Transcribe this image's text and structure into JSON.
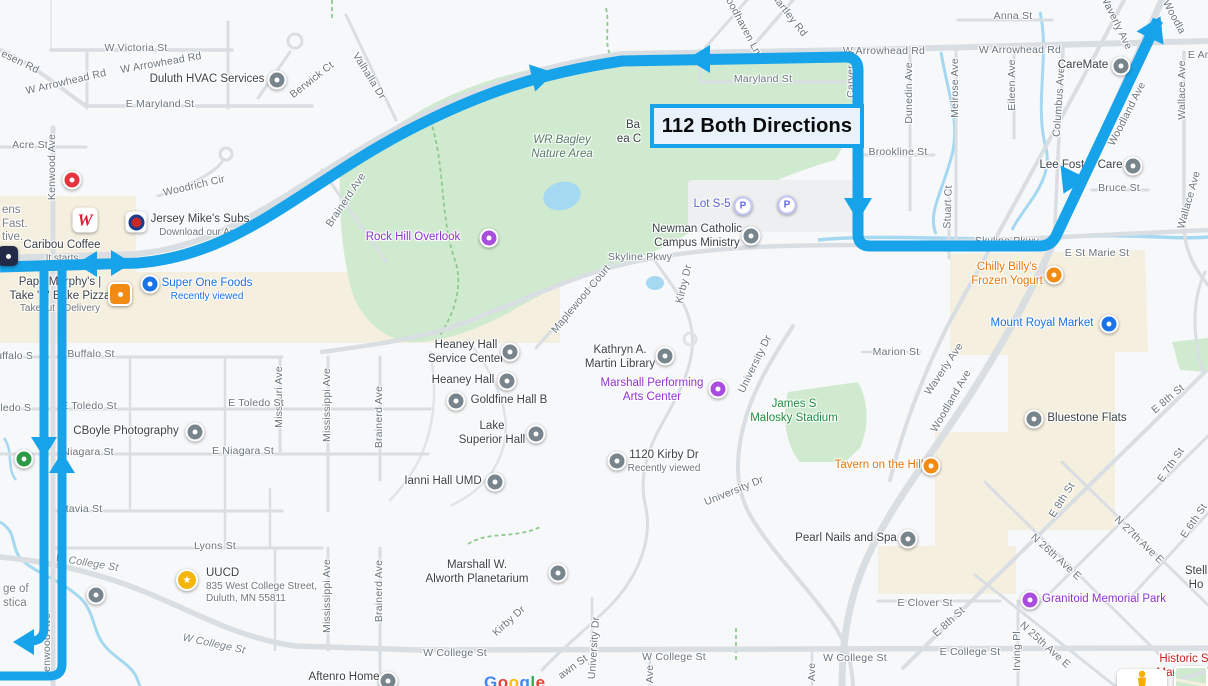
{
  "route": {
    "label": "112 Both Directions",
    "color": "#17a3e9"
  },
  "watermark": {
    "text": "Google",
    "letter_colors": [
      "#4285F4",
      "#EA4335",
      "#FBBC05",
      "#4285F4",
      "#34A853",
      "#EA4335"
    ]
  },
  "map": {
    "streets": [
      {
        "t": "W Victoria St",
        "x": 136,
        "y": 48,
        "r": 0
      },
      {
        "t": "esen Rd",
        "x": 20,
        "y": 62,
        "r": 26
      },
      {
        "t": "E Maryland St",
        "x": 160,
        "y": 104,
        "r": 0
      },
      {
        "t": "Acre St",
        "x": 30,
        "y": 145,
        "r": 0
      },
      {
        "t": "Kenwood Ave",
        "x": 52,
        "y": 167,
        "r": -90
      },
      {
        "t": "Berwick Ct",
        "x": 312,
        "y": 80,
        "r": -38
      },
      {
        "t": "Valhalla Dr",
        "x": 369,
        "y": 76,
        "r": 58
      },
      {
        "t": "W Arrowhead Rd",
        "x": 66,
        "y": 82,
        "r": -13
      },
      {
        "t": "W Arrowhead Rd",
        "x": 161,
        "y": 63,
        "r": -10
      },
      {
        "t": "Woodhaven Ln",
        "x": 741,
        "y": 22,
        "r": 62
      },
      {
        "t": "Hartley Rd",
        "x": 789,
        "y": 15,
        "r": 52
      },
      {
        "t": "Maryland St",
        "x": 763,
        "y": 79,
        "r": 0
      },
      {
        "t": "W Arrowhead Rd",
        "x": 884,
        "y": 51,
        "r": 0
      },
      {
        "t": "W Arrowhead Rd",
        "x": 1020,
        "y": 50,
        "r": 0
      },
      {
        "t": "Anna St",
        "x": 1013,
        "y": 16,
        "r": 0
      },
      {
        "t": "Carver Av",
        "x": 851,
        "y": 74,
        "r": -90
      },
      {
        "t": "Dunedin Ave",
        "x": 909,
        "y": 93,
        "r": -90
      },
      {
        "t": "Melrose Ave",
        "x": 955,
        "y": 88,
        "r": -90
      },
      {
        "t": "Eileen Ave",
        "x": 1012,
        "y": 85,
        "r": -90
      },
      {
        "t": "Columbus Ave",
        "x": 1059,
        "y": 102,
        "r": -86
      },
      {
        "t": "Waverly Ave",
        "x": 1116,
        "y": 22,
        "r": 64
      },
      {
        "t": "Woodla",
        "x": 1174,
        "y": 17,
        "r": 62
      },
      {
        "t": "E Arr",
        "x": 1200,
        "y": 55,
        "r": 0
      },
      {
        "t": "Wallace Ave",
        "x": 1182,
        "y": 90,
        "r": -90
      },
      {
        "t": "Wallace Ave",
        "x": 1189,
        "y": 200,
        "r": -74
      },
      {
        "t": "Brookline St",
        "x": 898,
        "y": 152,
        "r": 0
      },
      {
        "t": "Stuart Ct",
        "x": 948,
        "y": 207,
        "r": -88
      },
      {
        "t": "Bruce St",
        "x": 1119,
        "y": 188,
        "r": 0
      },
      {
        "t": "Skyline Pkwy",
        "x": 640,
        "y": 257,
        "r": 0
      },
      {
        "t": "Skyline Pkwy",
        "x": 1007,
        "y": 241,
        "r": 0
      },
      {
        "t": "E St Marie St",
        "x": 1097,
        "y": 253,
        "r": 0
      },
      {
        "t": "Marion St",
        "x": 896,
        "y": 352,
        "r": 0
      },
      {
        "t": "Waverly Ave",
        "x": 944,
        "y": 369,
        "r": -56
      },
      {
        "t": "Woodland Ave",
        "x": 1127,
        "y": 114,
        "r": -63
      },
      {
        "t": "Woodland Ave",
        "x": 951,
        "y": 401,
        "r": -60
      },
      {
        "t": "Maplewood Court",
        "x": 581,
        "y": 299,
        "r": -50
      },
      {
        "t": "Kirby Dr",
        "x": 684,
        "y": 284,
        "r": -76
      },
      {
        "t": "Kirby Dr",
        "x": 509,
        "y": 621,
        "r": -42
      },
      {
        "t": "University Dr",
        "x": 755,
        "y": 364,
        "r": -64
      },
      {
        "t": "University Dr",
        "x": 734,
        "y": 491,
        "r": -22
      },
      {
        "t": "University Dr",
        "x": 594,
        "y": 648,
        "r": -86
      },
      {
        "t": "Missouri Ave",
        "x": 279,
        "y": 397,
        "r": -90
      },
      {
        "t": "Mississippi Ave",
        "x": 327,
        "y": 405,
        "r": -90
      },
      {
        "t": "Brainerd Ave",
        "x": 379,
        "y": 417,
        "r": -90
      },
      {
        "t": "Brainerd Ave",
        "x": 346,
        "y": 200,
        "r": -56
      },
      {
        "t": "Mississippi Ave",
        "x": 327,
        "y": 596,
        "r": -90
      },
      {
        "t": "Brainerd Ave",
        "x": 379,
        "y": 591,
        "r": -90
      },
      {
        "t": "Buffalo S",
        "x": 11,
        "y": 356,
        "r": 0
      },
      {
        "t": "Buffalo St",
        "x": 91,
        "y": 354,
        "r": 0
      },
      {
        "t": "Toledo S",
        "x": 10,
        "y": 408,
        "r": 0
      },
      {
        "t": "E Toledo St",
        "x": 89,
        "y": 406,
        "r": 0
      },
      {
        "t": "E Toledo St",
        "x": 256,
        "y": 403,
        "r": 0
      },
      {
        "t": "Niagara St",
        "x": 88,
        "y": 452,
        "r": 0
      },
      {
        "t": "E Niagara St",
        "x": 243,
        "y": 451,
        "r": 0
      },
      {
        "t": "tavia St",
        "x": 84,
        "y": 509,
        "r": 0
      },
      {
        "t": "Lyons St",
        "x": 215,
        "y": 546,
        "r": 0
      },
      {
        "t": "W College St",
        "x": 87,
        "y": 563,
        "r": 9,
        "v": "i"
      },
      {
        "t": "W College St",
        "x": 214,
        "y": 644,
        "r": 12,
        "v": "i"
      },
      {
        "t": "W College St",
        "x": 455,
        "y": 653,
        "r": 0
      },
      {
        "t": "W College St",
        "x": 674,
        "y": 657,
        "r": 0
      },
      {
        "t": "W College St",
        "x": 855,
        "y": 658,
        "r": 0
      },
      {
        "t": "E College St",
        "x": 970,
        "y": 652,
        "r": 0
      },
      {
        "t": "E Clover St",
        "x": 925,
        "y": 603,
        "r": 0
      },
      {
        "t": "E 8th St",
        "x": 949,
        "y": 622,
        "r": -42
      },
      {
        "t": "E 8th St",
        "x": 1062,
        "y": 500,
        "r": -58
      },
      {
        "t": "E 8th St",
        "x": 1168,
        "y": 399,
        "r": -40
      },
      {
        "t": "E 7th St",
        "x": 1171,
        "y": 465,
        "r": -56
      },
      {
        "t": "E 6th St",
        "x": 1194,
        "y": 521,
        "r": -56
      },
      {
        "t": "N 27th Ave E",
        "x": 1139,
        "y": 540,
        "r": 44
      },
      {
        "t": "N 26th Ave E",
        "x": 1056,
        "y": 557,
        "r": 42
      },
      {
        "t": "N 25th Ave E",
        "x": 1045,
        "y": 645,
        "r": 42
      },
      {
        "t": "Irving Pl",
        "x": 1017,
        "y": 651,
        "r": -90
      },
      {
        "t": "awn St",
        "x": 573,
        "y": 667,
        "r": -36
      },
      {
        "t": "Woodrich Cir",
        "x": 194,
        "y": 186,
        "r": -13
      },
      {
        "t": "Kenwood Ave",
        "x": 47,
        "y": 646,
        "r": -90
      },
      {
        "t": "Ave",
        "x": 650,
        "y": 674,
        "r": -90
      },
      {
        "t": "Ave",
        "x": 812,
        "y": 672,
        "r": -90
      }
    ],
    "pois": [
      {
        "x": 207,
        "y": 80,
        "lines": [
          "Duluth HVAC Services"
        ],
        "cls": "dark",
        "pin": {
          "t": "dot",
          "c": "grey",
          "x": 277,
          "y": 80
        }
      },
      {
        "x": 200,
        "y": 220,
        "lines": [
          "Jersey Mike's Subs"
        ],
        "cls": "dark",
        "sub": [
          "Download our App"
        ],
        "pin": {
          "t": "jm",
          "x": 136,
          "y": 222
        }
      },
      {
        "x": 62,
        "y": 246,
        "lines": [
          "Caribou Coffee"
        ],
        "cls": "dark",
        "sub": [
          "It starts"
        ],
        "pin": {
          "t": "caribou",
          "x": 8,
          "y": 256
        }
      },
      {
        "x": 60,
        "y": 283,
        "lines": [
          "Papa Murphy's |",
          "Take 'N' Bake Pizza"
        ],
        "cls": "dark",
        "sub": [
          "Takeout • Delivery"
        ],
        "pin": {
          "t": "sq",
          "c": "orange",
          "x": 120,
          "y": 294
        }
      },
      {
        "x": 207,
        "y": 284,
        "lines": [
          "Super One Foods"
        ],
        "cls": "blue",
        "sub": [
          "Recently viewed"
        ],
        "subCls": "blue",
        "pin": {
          "t": "dot",
          "c": "blue",
          "x": 150,
          "y": 284
        }
      },
      {
        "x": 413,
        "y": 238,
        "lines": [
          "Rock Hill Overlook"
        ],
        "cls": "purple",
        "pin": {
          "t": "dot",
          "c": "purple",
          "x": 489,
          "y": 238
        }
      },
      {
        "x": 562,
        "y": 141,
        "lines": [
          "WR Bagley",
          "Nature Area"
        ],
        "cls": "teal"
      },
      {
        "x": 633,
        "y": 126,
        "lines": [
          "Ba"
        ],
        "cls": "dark"
      },
      {
        "x": 629,
        "y": 140,
        "lines": [
          "ea C"
        ],
        "cls": "dark"
      },
      {
        "x": 712,
        "y": 205,
        "lines": [
          "Lot S-5"
        ],
        "cls": "indigo"
      },
      {
        "x": 697,
        "y": 230,
        "lines": [
          "Newman Catholic",
          "Campus Ministry"
        ],
        "cls": "dark",
        "pin": {
          "t": "dot",
          "c": "grey",
          "x": 751,
          "y": 236
        }
      },
      {
        "x": 1007,
        "y": 268,
        "lines": [
          "Chilly Billy's",
          "Frozen Yogurt"
        ],
        "cls": "orange",
        "pin": {
          "t": "dot",
          "c": "orange",
          "x": 1054,
          "y": 275
        }
      },
      {
        "x": 1042,
        "y": 324,
        "lines": [
          "Mount Royal Market"
        ],
        "cls": "blue",
        "pin": {
          "t": "dot",
          "c": "blue",
          "x": 1109,
          "y": 324
        }
      },
      {
        "x": 1081,
        "y": 166,
        "lines": [
          "Lee Foster Care"
        ],
        "cls": "dark",
        "pin": {
          "t": "dot",
          "c": "grey",
          "x": 1133,
          "y": 166
        }
      },
      {
        "x": 1083,
        "y": 66,
        "lines": [
          "CareMate"
        ],
        "cls": "dark",
        "pin": {
          "t": "dot",
          "c": "grey",
          "x": 1121,
          "y": 66
        }
      },
      {
        "x": 1087,
        "y": 419,
        "lines": [
          "Bluestone Flats"
        ],
        "cls": "dark",
        "pin": {
          "t": "dot",
          "c": "grey",
          "x": 1034,
          "y": 419
        }
      },
      {
        "x": 879,
        "y": 466,
        "lines": [
          "Tavern on the Hill"
        ],
        "cls": "orange",
        "pin": {
          "t": "dot",
          "c": "orange",
          "x": 931,
          "y": 466
        }
      },
      {
        "x": 846,
        "y": 539,
        "lines": [
          "Pearl Nails and Spa"
        ],
        "cls": "dark",
        "pin": {
          "t": "dot",
          "c": "grey",
          "x": 908,
          "y": 539
        }
      },
      {
        "x": 1104,
        "y": 600,
        "lines": [
          "Granitoid Memorial Park"
        ],
        "cls": "purple",
        "pin": {
          "t": "dot",
          "c": "purple",
          "x": 1030,
          "y": 600
        }
      },
      {
        "x": 1196,
        "y": 572,
        "lines": [
          "Stell",
          "Ho"
        ],
        "cls": "dark"
      },
      {
        "x": 1184,
        "y": 660,
        "lines": [
          "Historic S",
          "Mansion D"
        ],
        "cls": "red"
      },
      {
        "x": 466,
        "y": 346,
        "lines": [
          "Heaney Hall",
          "Service Center"
        ],
        "cls": "dark",
        "pin": {
          "t": "dot",
          "c": "grey",
          "x": 510,
          "y": 352
        }
      },
      {
        "x": 463,
        "y": 381,
        "lines": [
          "Heaney Hall"
        ],
        "cls": "dark",
        "pin": {
          "t": "dot",
          "c": "grey",
          "x": 507,
          "y": 381
        }
      },
      {
        "x": 509,
        "y": 401,
        "lines": [
          "Goldfine Hall B"
        ],
        "cls": "dark",
        "pin": {
          "t": "dot",
          "c": "grey",
          "x": 456,
          "y": 401
        }
      },
      {
        "x": 492,
        "y": 427,
        "lines": [
          "Lake",
          "Superior Hall"
        ],
        "cls": "dark",
        "pin": {
          "t": "dot",
          "c": "grey",
          "x": 536,
          "y": 434
        }
      },
      {
        "x": 620,
        "y": 351,
        "lines": [
          "Kathryn A.",
          "Martin Library"
        ],
        "cls": "dark",
        "pin": {
          "t": "dot",
          "c": "grey",
          "x": 665,
          "y": 356
        }
      },
      {
        "x": 652,
        "y": 384,
        "lines": [
          "Marshall Performing",
          "Arts Center"
        ],
        "cls": "purple",
        "pin": {
          "t": "dot",
          "c": "purple",
          "x": 718,
          "y": 389
        }
      },
      {
        "x": 794,
        "y": 405,
        "lines": [
          "James S",
          "Malosky Stadium"
        ],
        "cls": "green"
      },
      {
        "x": 664,
        "y": 456,
        "lines": [
          "1120 Kirby Dr"
        ],
        "cls": "dark",
        "sub": [
          "Recently viewed"
        ],
        "pin": {
          "t": "dot",
          "c": "grey",
          "x": 617,
          "y": 461
        }
      },
      {
        "x": 443,
        "y": 482,
        "lines": [
          "Ianni Hall UMD"
        ],
        "cls": "dark",
        "pin": {
          "t": "dot",
          "c": "grey",
          "x": 495,
          "y": 482
        }
      },
      {
        "x": 477,
        "y": 566,
        "lines": [
          "Marshall W.",
          "Alworth Planetarium"
        ],
        "cls": "dark",
        "pin": {
          "t": "dot",
          "c": "grey",
          "x": 558,
          "y": 573
        }
      },
      {
        "x": 206,
        "y": 574,
        "align": "left",
        "lines": [
          "UUCD"
        ],
        "cls": "dark",
        "sub": [
          "835 West College Street,",
          "Duluth, MN 55811"
        ],
        "pin": {
          "t": "star",
          "x": 187,
          "y": 580
        }
      },
      {
        "x": 126,
        "y": 432,
        "lines": [
          "CBoyle Photography"
        ],
        "cls": "dark",
        "pin": {
          "t": "dot",
          "c": "grey",
          "x": 195,
          "y": 432
        }
      },
      {
        "x": 3,
        "y": 590,
        "align": "left",
        "lines": [
          "ge of",
          "stica"
        ],
        "cls": "grey",
        "pin": {
          "t": "dot",
          "c": "grey",
          "x": 96,
          "y": 595
        }
      },
      {
        "x": 344,
        "y": 678,
        "lines": [
          "Aftenro Home"
        ],
        "cls": "dark",
        "pin": {
          "t": "dot",
          "c": "grey",
          "x": 388,
          "y": 681
        }
      },
      {
        "x": 2,
        "y": 211,
        "align": "left",
        "lines": [
          "ens",
          "Fast.",
          "tive."
        ],
        "cls": "grey"
      }
    ],
    "pins": [
      {
        "t": "dot",
        "c": "green",
        "x": 24,
        "y": 459
      },
      {
        "t": "dot",
        "c": "red",
        "x": 72,
        "y": 180
      },
      {
        "t": "wal",
        "x": 85,
        "y": 220
      },
      {
        "t": "parking",
        "x": 743,
        "y": 206
      },
      {
        "t": "parking",
        "x": 787,
        "y": 205
      }
    ]
  }
}
